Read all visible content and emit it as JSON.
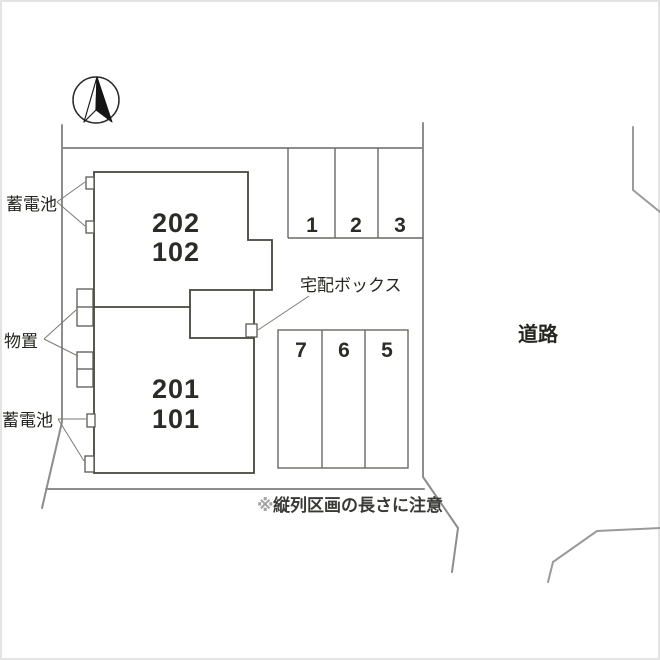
{
  "site": {
    "road_label": "道路",
    "note_mark": "※",
    "note_body": "縦列区画の長さに注意"
  },
  "building": {
    "fill_color": "#FBF8C5",
    "upper_unit": {
      "line1": "202",
      "line2": "102"
    },
    "lower_unit": {
      "line1": "201",
      "line2": "101"
    }
  },
  "equipment": {
    "battery_top_label": "蓄電池",
    "battery_bottom_label": "蓄電池",
    "storage_label": "物置",
    "delivery_box_label": "宅配ボックス"
  },
  "parking": {
    "row_top": {
      "spaces": [
        "1",
        "2",
        "3"
      ]
    },
    "row_middle": {
      "spaces": [
        "7",
        "6",
        "5"
      ]
    }
  },
  "colors": {
    "boundary_line": "#8d8d8d",
    "building_outline": "#45443a",
    "text": "#26261f"
  }
}
